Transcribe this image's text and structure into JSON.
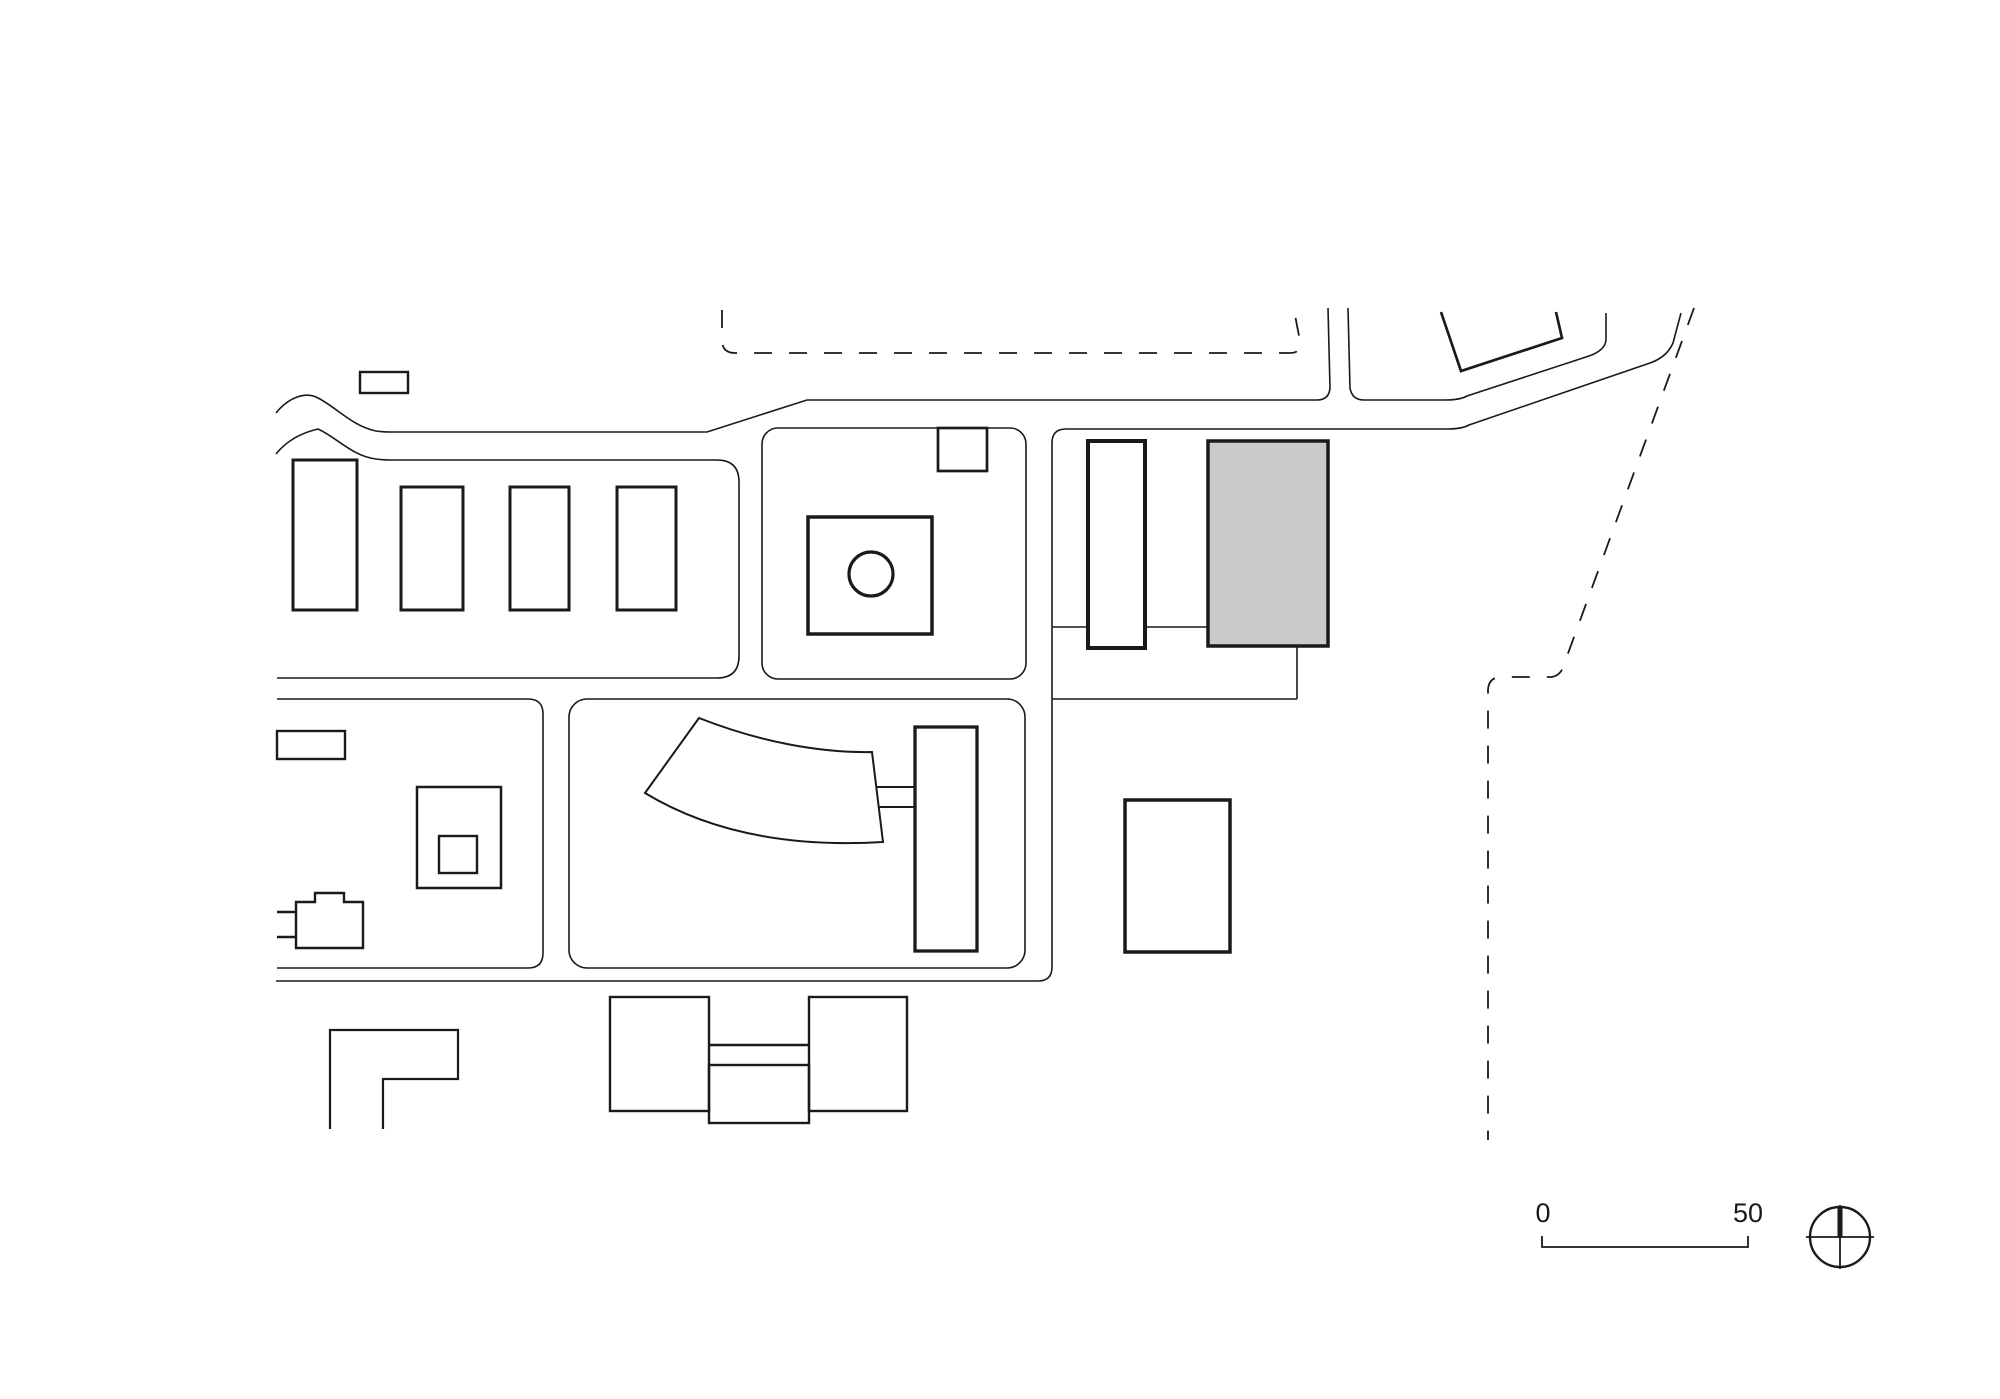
{
  "page": {
    "background": "#ffffff",
    "kind": "architectural site plan drawing"
  },
  "colors": {
    "ink": "#1a1a1a",
    "highlight_fill": "#cacaca",
    "paper": "#ffffff"
  },
  "scale_bar": {
    "start_label": "0",
    "end_label": "50"
  },
  "drawing": {
    "type": "site-plan",
    "highlighted_building": "gray filled rectangle, upper right block",
    "elements": [
      "main road with wavy open west ends",
      "north access road exiting top",
      "northeast diagonal road exit",
      "dashed site boundary north",
      "dashed site boundary east",
      "block with four row houses",
      "block with courtyard building and circle",
      "block with slab building and highlighted building",
      "block with fan-shaped hall and tall slab",
      "block with nested square building",
      "small outbuilding north of road",
      "tilted building northeast",
      "freestanding rectangular building east",
      "twin buildings with connector south",
      "L-shaped building southwest",
      "scale bar",
      "north symbol"
    ]
  }
}
